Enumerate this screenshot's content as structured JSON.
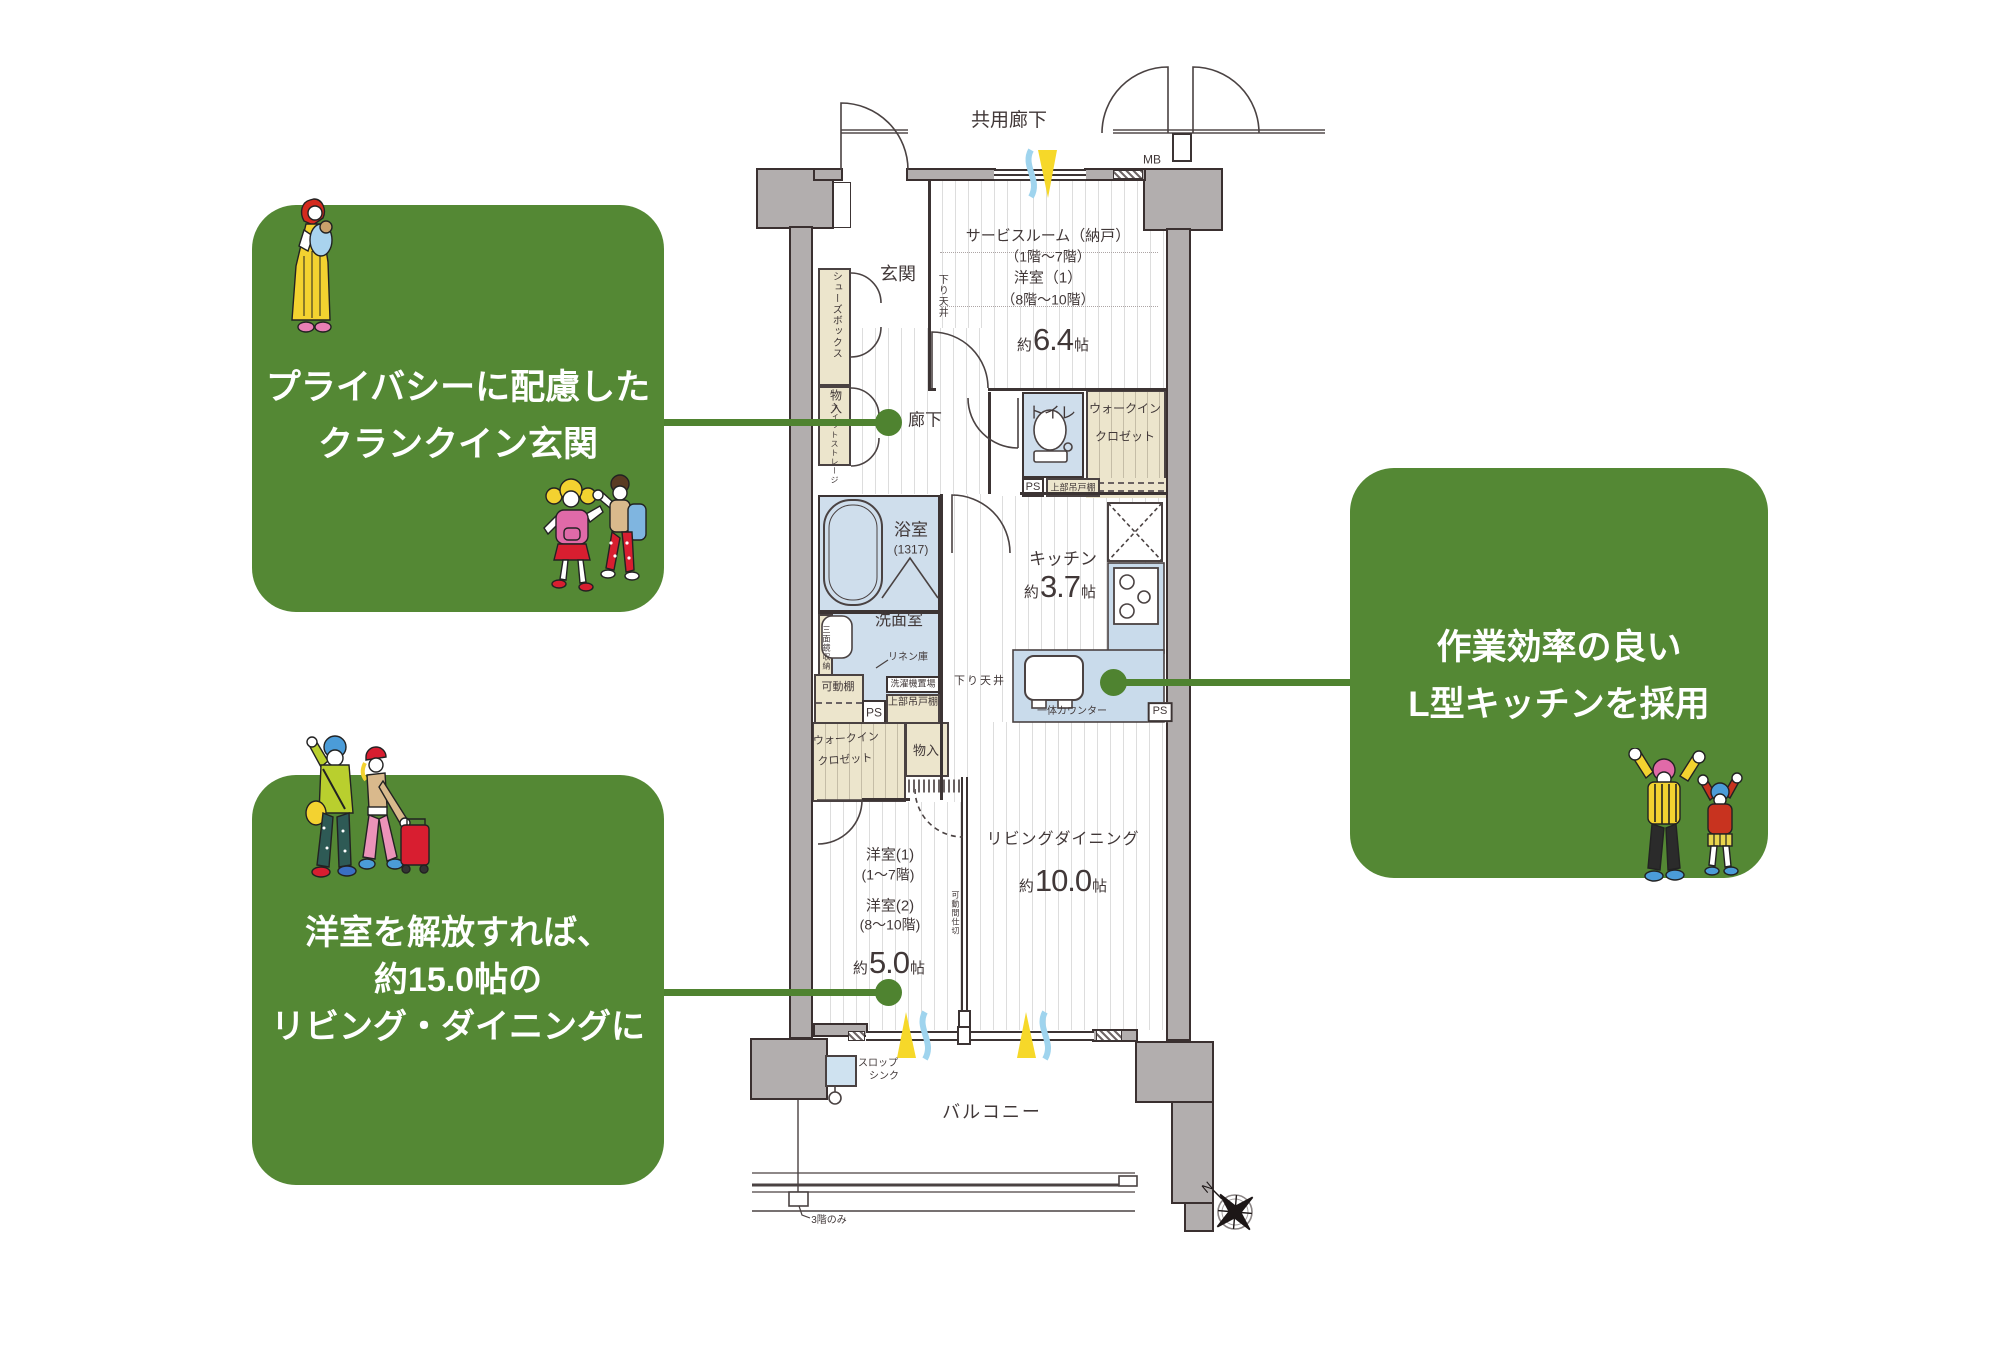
{
  "colors": {
    "accent_green": "#548834",
    "connector_green": "#4f8330",
    "room_blue": "#cfdeec",
    "cabinet_beige": "#ece5cc",
    "wall_gray": "#b2aeae",
    "counter_blue": "#c9dbeb",
    "sun_yellow": "#f6d829",
    "breeze_blue": "#9fd4ee"
  },
  "callouts": {
    "privacy": {
      "line1": "プライバシーに配慮した",
      "line2": "クランクイン玄関"
    },
    "open_living": {
      "line1": "洋室を解放すれば、",
      "line2": "約15.0帖の",
      "line3": "リビング・ダイニングに"
    },
    "kitchen_feature": {
      "line1": "作業効率の良い",
      "line2": "L型キッチンを採用"
    }
  },
  "plan": {
    "common_corridor": "共用廊下",
    "mb": "MB",
    "service_room": {
      "line1": "サービスルーム（納戸）",
      "line2": "（1階〜7階）",
      "line3": "洋室（1）",
      "line4": "（8階〜10階）",
      "area_prefix": "約",
      "area_value": "6.4",
      "area_unit": "帖"
    },
    "genkan": "玄関",
    "shoes_box": "シューズボックス",
    "storage": "物入",
    "fit_storage": "フィットストレージ",
    "corridor": "廊下",
    "down_ceiling": "下り天井",
    "toilet": "トイレ",
    "ps": "PS",
    "upper_cabinet": "上部吊戸棚",
    "wic_line1": "ウォークイン",
    "wic_line2": "クロゼット",
    "bath": "浴室",
    "bath_size": "(1317)",
    "washroom": "洗面室",
    "linen": "リネン庫",
    "mirror_storage": "三面鏡収納",
    "movable_shelf": "可動棚",
    "washer_space": "洗濯機置場",
    "kitchen": {
      "name": "キッチン",
      "area_prefix": "約",
      "area_value": "3.7",
      "area_unit": "帖",
      "counter": "一体カウンター"
    },
    "living": {
      "name": "リビングダイニング",
      "area_prefix": "約",
      "area_value": "10.0",
      "area_unit": "帖"
    },
    "bedroom": {
      "line1": "洋室(1)",
      "line2": "(1〜7階)",
      "line3": "洋室(2)",
      "line4": "(8〜10階)",
      "area_prefix": "約",
      "area_value": "5.0",
      "area_unit": "帖"
    },
    "partition": "可動間仕切",
    "balcony": "バルコニー",
    "slop_sink_line1": "スロップ",
    "slop_sink_line2": "シンク",
    "third_floor_only": "3階のみ",
    "compass_north": "N"
  }
}
